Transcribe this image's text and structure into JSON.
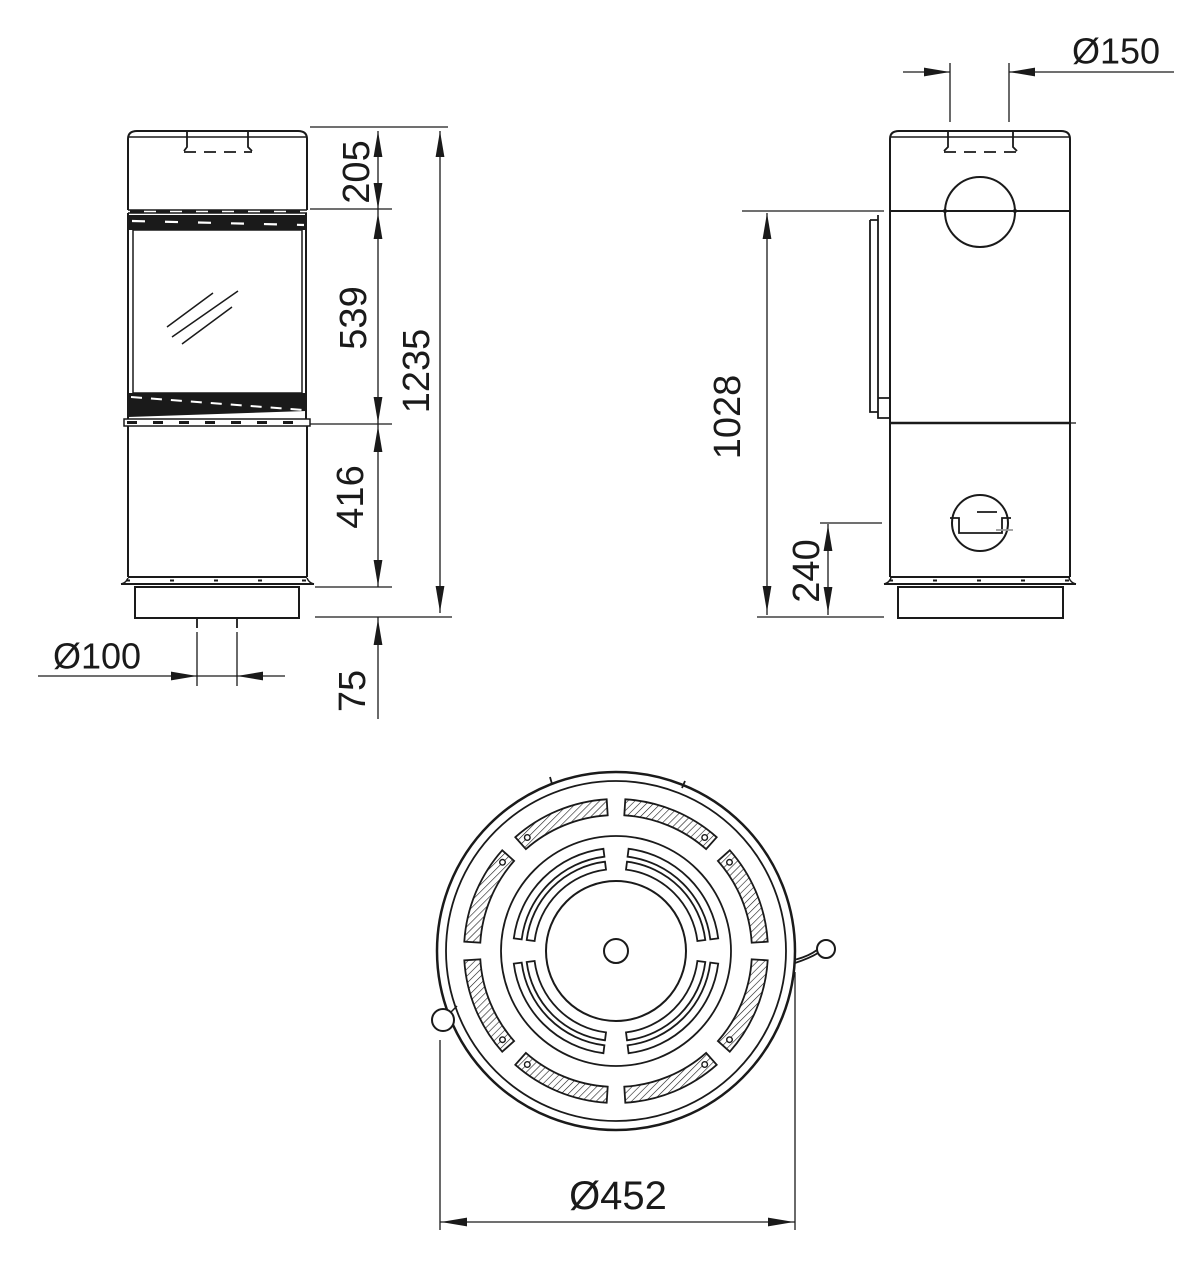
{
  "colors": {
    "line": "#1a1a1a",
    "background": "#ffffff"
  },
  "dimensions": {
    "front": {
      "top_section": "205",
      "window_section": "539",
      "total_height": "1235",
      "lower_section": "416",
      "plinth_height": "75",
      "floor_flue_diameter": "Ø100"
    },
    "side": {
      "flue_diameter": "Ø150",
      "body_below_top": "1028",
      "air_inlet_center_height": "240"
    },
    "top": {
      "outer_diameter": "Ø452"
    }
  }
}
